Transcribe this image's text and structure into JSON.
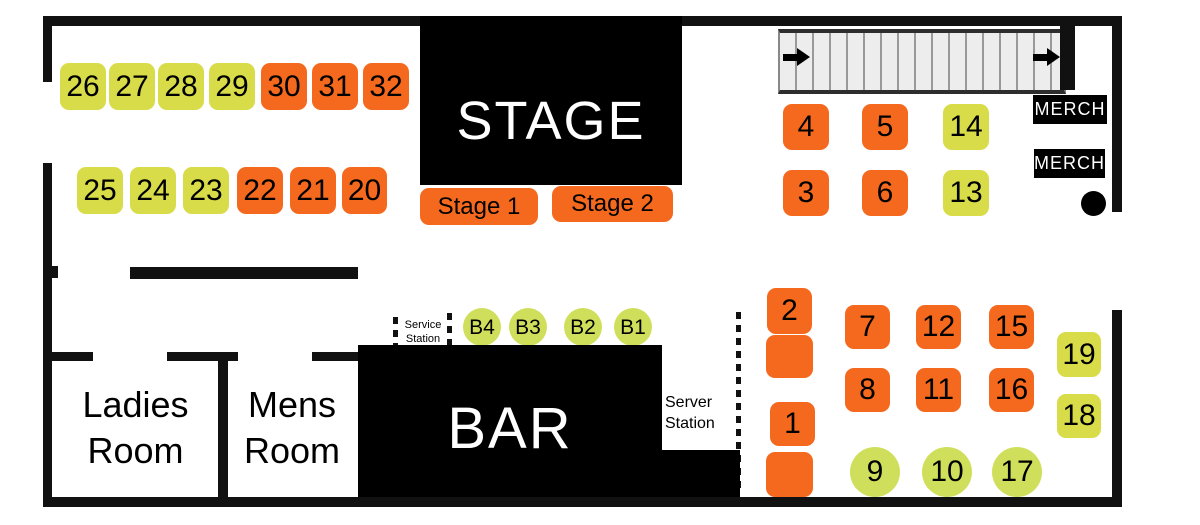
{
  "colors": {
    "orange": "#f4691e",
    "yellow": "#d8dc49",
    "yellow_circle": "#cfdf5b",
    "wall": "#111111",
    "block_black": "#000000",
    "stair_fill": "#ededed"
  },
  "stage": {
    "label": "STAGE",
    "buttons": [
      {
        "label": "Stage 1"
      },
      {
        "label": "Stage 2"
      }
    ]
  },
  "bar": {
    "label": "BAR"
  },
  "rooms": [
    {
      "line1": "Ladies",
      "line2": "Room"
    },
    {
      "line1": "Mens",
      "line2": "Room"
    }
  ],
  "stations": {
    "service": {
      "line1": "Service",
      "line2": "Station"
    },
    "server": {
      "line1": "Server",
      "line2": "Station"
    }
  },
  "merch": {
    "labels": [
      "MERCH",
      "MERCH"
    ]
  },
  "seats": [
    {
      "label": "26",
      "shape": "square",
      "color": "yellow",
      "x": 60,
      "y": 63,
      "w": 46,
      "h": 47
    },
    {
      "label": "27",
      "shape": "square",
      "color": "yellow",
      "x": 109,
      "y": 63,
      "w": 46,
      "h": 47
    },
    {
      "label": "28",
      "shape": "square",
      "color": "yellow",
      "x": 158,
      "y": 63,
      "w": 46,
      "h": 47
    },
    {
      "label": "29",
      "shape": "square",
      "color": "yellow",
      "x": 209,
      "y": 63,
      "w": 46,
      "h": 47
    },
    {
      "label": "30",
      "shape": "square",
      "color": "orange",
      "x": 261,
      "y": 63,
      "w": 46,
      "h": 47
    },
    {
      "label": "31",
      "shape": "square",
      "color": "orange",
      "x": 312,
      "y": 63,
      "w": 46,
      "h": 47
    },
    {
      "label": "32",
      "shape": "square",
      "color": "orange",
      "x": 363,
      "y": 63,
      "w": 46,
      "h": 47
    },
    {
      "label": "25",
      "shape": "square",
      "color": "yellow",
      "x": 77,
      "y": 167,
      "w": 46,
      "h": 47
    },
    {
      "label": "24",
      "shape": "square",
      "color": "yellow",
      "x": 130,
      "y": 167,
      "w": 46,
      "h": 47
    },
    {
      "label": "23",
      "shape": "square",
      "color": "yellow",
      "x": 183,
      "y": 167,
      "w": 46,
      "h": 47
    },
    {
      "label": "22",
      "shape": "square",
      "color": "orange",
      "x": 237,
      "y": 167,
      "w": 46,
      "h": 47
    },
    {
      "label": "21",
      "shape": "square",
      "color": "orange",
      "x": 290,
      "y": 167,
      "w": 46,
      "h": 47
    },
    {
      "label": "20",
      "shape": "square",
      "color": "orange",
      "x": 342,
      "y": 167,
      "w": 45,
      "h": 47
    },
    {
      "label": "4",
      "shape": "square",
      "color": "orange",
      "x": 783,
      "y": 104,
      "w": 46,
      "h": 46
    },
    {
      "label": "5",
      "shape": "square",
      "color": "orange",
      "x": 862,
      "y": 104,
      "w": 46,
      "h": 46
    },
    {
      "label": "14",
      "shape": "square",
      "color": "yellow",
      "x": 943,
      "y": 104,
      "w": 46,
      "h": 46
    },
    {
      "label": "3",
      "shape": "square",
      "color": "orange",
      "x": 783,
      "y": 170,
      "w": 46,
      "h": 46
    },
    {
      "label": "6",
      "shape": "square",
      "color": "orange",
      "x": 862,
      "y": 170,
      "w": 46,
      "h": 46
    },
    {
      "label": "13",
      "shape": "square",
      "color": "yellow",
      "x": 943,
      "y": 170,
      "w": 46,
      "h": 46
    },
    {
      "label": "2",
      "shape": "square",
      "color": "orange",
      "x": 767,
      "y": 288,
      "w": 45,
      "h": 46
    },
    {
      "label": "",
      "shape": "square",
      "color": "orange",
      "x": 766,
      "y": 335,
      "w": 47,
      "h": 43
    },
    {
      "label": "7",
      "shape": "square",
      "color": "orange",
      "x": 845,
      "y": 305,
      "w": 45,
      "h": 44
    },
    {
      "label": "12",
      "shape": "square",
      "color": "orange",
      "x": 916,
      "y": 305,
      "w": 45,
      "h": 44
    },
    {
      "label": "15",
      "shape": "square",
      "color": "orange",
      "x": 989,
      "y": 305,
      "w": 45,
      "h": 44
    },
    {
      "label": "8",
      "shape": "square",
      "color": "orange",
      "x": 845,
      "y": 368,
      "w": 45,
      "h": 44
    },
    {
      "label": "11",
      "shape": "square",
      "color": "orange",
      "x": 916,
      "y": 368,
      "w": 45,
      "h": 44
    },
    {
      "label": "16",
      "shape": "square",
      "color": "orange",
      "x": 989,
      "y": 368,
      "w": 45,
      "h": 44
    },
    {
      "label": "19",
      "shape": "square",
      "color": "yellow",
      "x": 1057,
      "y": 332,
      "w": 44,
      "h": 45
    },
    {
      "label": "18",
      "shape": "square",
      "color": "yellow",
      "x": 1057,
      "y": 394,
      "w": 44,
      "h": 44
    },
    {
      "label": "1",
      "shape": "square",
      "color": "orange",
      "x": 770,
      "y": 402,
      "w": 45,
      "h": 44
    },
    {
      "label": "",
      "shape": "square",
      "color": "orange",
      "x": 766,
      "y": 452,
      "w": 47,
      "h": 45
    },
    {
      "label": "9",
      "shape": "circle",
      "color": "yellow_circle",
      "x": 850,
      "y": 447,
      "w": 50,
      "h": 50
    },
    {
      "label": "10",
      "shape": "circle",
      "color": "yellow_circle",
      "x": 922,
      "y": 447,
      "w": 50,
      "h": 50
    },
    {
      "label": "17",
      "shape": "circle",
      "color": "yellow_circle",
      "x": 992,
      "y": 447,
      "w": 50,
      "h": 50
    },
    {
      "label": "B4",
      "shape": "circle",
      "color": "yellow_circle",
      "x": 463,
      "y": 308,
      "w": 38,
      "h": 38,
      "fs": 21
    },
    {
      "label": "B3",
      "shape": "circle",
      "color": "yellow_circle",
      "x": 509,
      "y": 308,
      "w": 38,
      "h": 38,
      "fs": 21
    },
    {
      "label": "B2",
      "shape": "circle",
      "color": "yellow_circle",
      "x": 564,
      "y": 308,
      "w": 38,
      "h": 38,
      "fs": 21
    },
    {
      "label": "B1",
      "shape": "circle",
      "color": "yellow_circle",
      "x": 614,
      "y": 308,
      "w": 38,
      "h": 38,
      "fs": 21
    }
  ]
}
